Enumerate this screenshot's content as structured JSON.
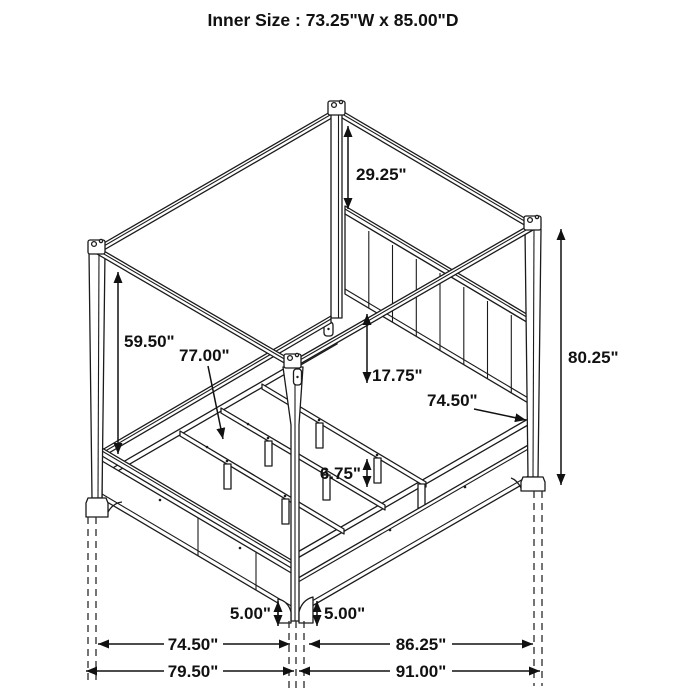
{
  "title": "Inner Size : 73.25\"W x 85.00\"D",
  "diagram_type": "isometric canopy bed dimension drawing",
  "labels": {
    "post_above_headboard": "29.25\"",
    "footboard_post_height": "59.50\"",
    "slat_length": "77.00\"",
    "headboard_rail_to_slat": "17.75\"",
    "mattress_rail_length": "74.50\"",
    "overall_height": "80.25\"",
    "center_leg_height": "6.75\"",
    "foot_height_left": "5.00\"",
    "foot_height_right": "5.00\"",
    "footboard_span": "74.50\"",
    "overall_width": "79.50\"",
    "side_rail_span": "86.25\"",
    "overall_depth": "91.00\""
  }
}
